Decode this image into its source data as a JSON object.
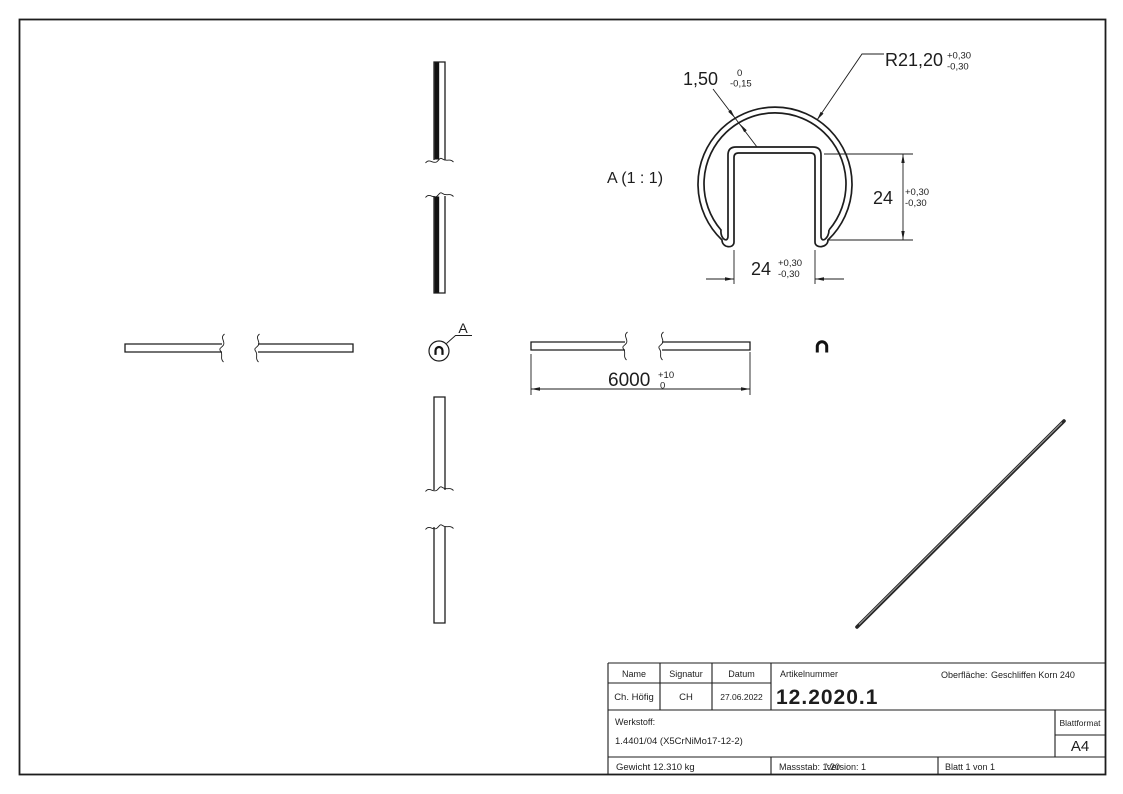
{
  "detail_view": {
    "label": "A (1 : 1)",
    "wall_dim": {
      "value": "1,50",
      "tol_top": "0",
      "tol_bottom": "-0,15"
    },
    "radius_dim": {
      "value": "R21,20",
      "tol_top": "+0,30",
      "tol_bottom": "-0,30"
    },
    "height_dim": {
      "value": "24",
      "tol_top": "+0,30",
      "tol_bottom": "-0,30"
    },
    "width_dim": {
      "value": "24",
      "tol_top": "+0,30",
      "tol_bottom": "-0,30"
    }
  },
  "front_view": {
    "length_dim": {
      "value": "6000",
      "tol_top": "+10",
      "tol_bottom": "0"
    }
  },
  "section_marker": {
    "label": "A"
  },
  "title_block": {
    "name_header": "Name",
    "signatur_header": "Signatur",
    "datum_header": "Datum",
    "name": "Ch. Höfig",
    "signatur": "CH",
    "datum": "27.06.2022",
    "artikelnummer_label": "Artikelnummer",
    "artikelnummer": "12.2020.1",
    "oberflaeche_label": "Oberfläche:",
    "oberflaeche_value": "Geschliffen Korn 240",
    "werkstoff_label": "Werkstoff:",
    "werkstoff_value": "1.4401/04 (X5CrNiMo17-12-2)",
    "blattformat_label": "Blattformat",
    "blattformat_value": "A4",
    "gewicht": "Gewicht 12.310 kg",
    "massstab": "Massstab: 1:20",
    "version": "Version: 1",
    "blatt": "Blatt 1 von 1"
  }
}
